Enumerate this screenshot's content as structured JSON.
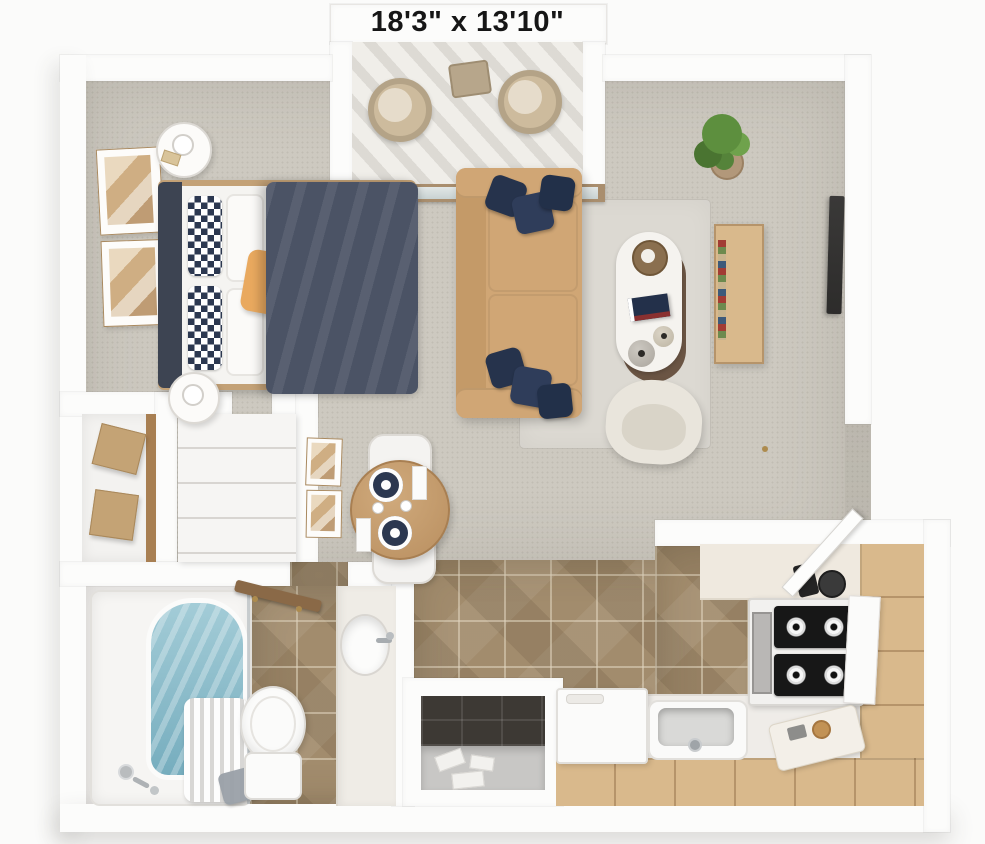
{
  "header": {
    "dimensions_label": "18'3\" x 13'10\""
  },
  "palette": {
    "bg": "#fbfbfa",
    "wall": "#fcfcfb",
    "carpet": "#cdc9c0",
    "rug": "#dcd9d2",
    "tile": "#a28c6d",
    "bathfloor": "#ebe9e7",
    "sofa": "#d0a675",
    "sofadark": "#c49a68",
    "navy": "#2c3850",
    "duvet": "#4b5365",
    "headboard": "#3d4452",
    "accent": "#e9a95f",
    "wood": "#c3a176",
    "kwood": "#d9b98c",
    "kwoodline": "#b6946a",
    "water": "#86bac9",
    "green": "#5d8f3e",
    "cream": "#e9e5dc",
    "tv": "#2d2c2b",
    "brass": "#ad8b4e",
    "glassframe": "#a98e6e",
    "white": "#fafaf8",
    "darktile": "#3d3934",
    "text": "#161616"
  }
}
